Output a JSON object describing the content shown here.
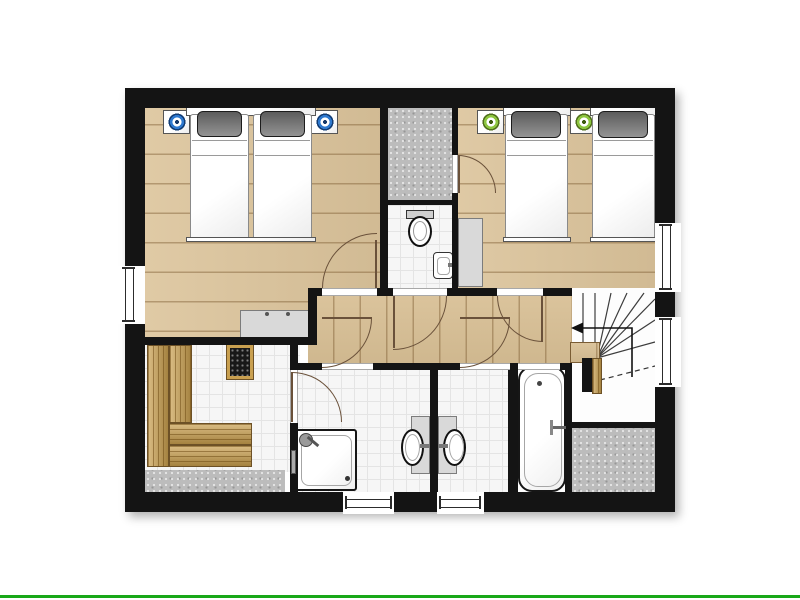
{
  "page": {
    "background_color": "#ffffff",
    "bottom_divider_color": "#18a818"
  },
  "floorplan": {
    "type": "architectural-floor-plan-upper-floor",
    "wall_color": "#141414",
    "floor_colors": {
      "wood": "#dcc49b",
      "tile": "#f6f6f6",
      "storage_gray": "#bcbcbc",
      "sauna_bench_wood": "#c99f4e"
    },
    "accent_colors": {
      "nightstand_disc_blue": "#2e79cf",
      "nightstand_disc_green": "#8dc63f",
      "pillow_gray": "#6f6f6f",
      "door_arc_brown": "#6a513a"
    },
    "rooms": [
      {
        "name": "bedroom-1",
        "floor": "wood",
        "furniture": [
          "double-bed",
          "two-gray-pillows",
          "nightstand-blue-left",
          "nightstand-blue-right",
          "dresser"
        ]
      },
      {
        "name": "bedroom-2",
        "floor": "wood",
        "furniture": [
          "single-bed-left",
          "single-bed-right",
          "nightstand-green-left",
          "nightstand-green-right",
          "wardrobe"
        ]
      },
      {
        "name": "walk-in-closet",
        "floor": "storage_gray",
        "furniture": []
      },
      {
        "name": "wc",
        "floor": "tile",
        "furniture": [
          "toilet",
          "hand-basin"
        ]
      },
      {
        "name": "hallway",
        "floor": "wood",
        "furniture": []
      },
      {
        "name": "sauna",
        "floor": "tile",
        "furniture": [
          "l-shaped-tiered-benches",
          "sauna-heater"
        ]
      },
      {
        "name": "bathroom-left",
        "floor": "tile",
        "furniture": [
          "corner-shower",
          "washbasin"
        ]
      },
      {
        "name": "bathroom-right",
        "floor": "tile",
        "furniture": [
          "washbasin",
          "bathtub"
        ]
      },
      {
        "name": "staircase",
        "floor": "white",
        "furniture": [
          "winder-stairs",
          "down-direction-arrow"
        ]
      },
      {
        "name": "understairs-storage",
        "floor": "storage_gray",
        "furniture": []
      }
    ],
    "windows": [
      "left-wall-bedroom-1",
      "right-wall-bedroom-2",
      "right-wall-staircase",
      "bottom-wall-bathroom-left",
      "bottom-wall-bathroom-right"
    ],
    "doors": [
      "bedroom-1-door",
      "wc-door",
      "bedroom-2-door",
      "closet-door",
      "bathroom-left-door",
      "bathroom-right-door",
      "sauna-door",
      "bathtub-niche-opening"
    ]
  }
}
